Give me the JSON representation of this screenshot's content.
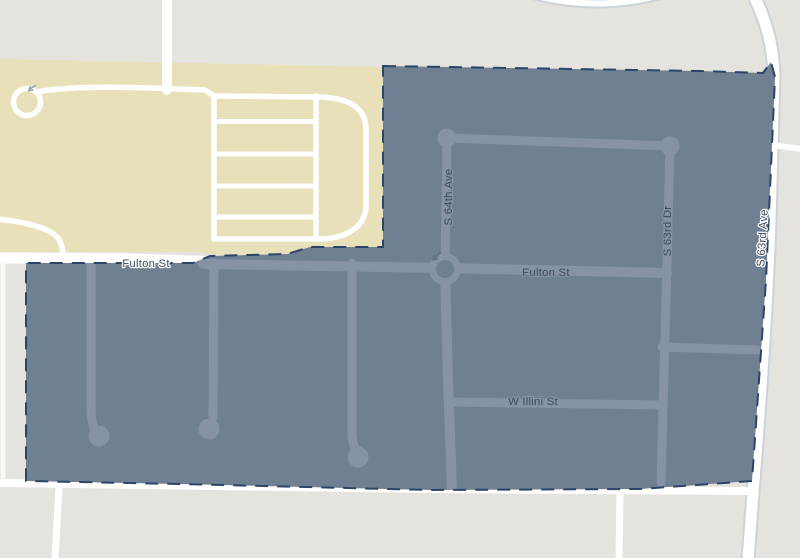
{
  "map": {
    "street_labels": {
      "fulton_st_west": "Fulton St",
      "fulton_st_east": "Fulton St",
      "w_illini_st": "W Illini St",
      "s_64th_ave": "S 64th Ave",
      "s_63rd_dr": "S 63rd Dr",
      "s_63rd_ave": "S 63rd Ave"
    },
    "icons": {
      "roundabout_arrow": "one-way-arrow",
      "loop_arrow": "one-way-arrow"
    },
    "colors": {
      "background": "#e5e3de",
      "landuse": "#e8e0b8",
      "road": "#ffffff",
      "road_casing": "#ccd3d9",
      "selection_fill": "#6f8093",
      "selection_border": "#2c4566",
      "selection_road": "#8593a5",
      "label": "#3c4a5e",
      "arrow_dark": "#5f7087",
      "arrow_light": "#9aa2ac"
    }
  }
}
